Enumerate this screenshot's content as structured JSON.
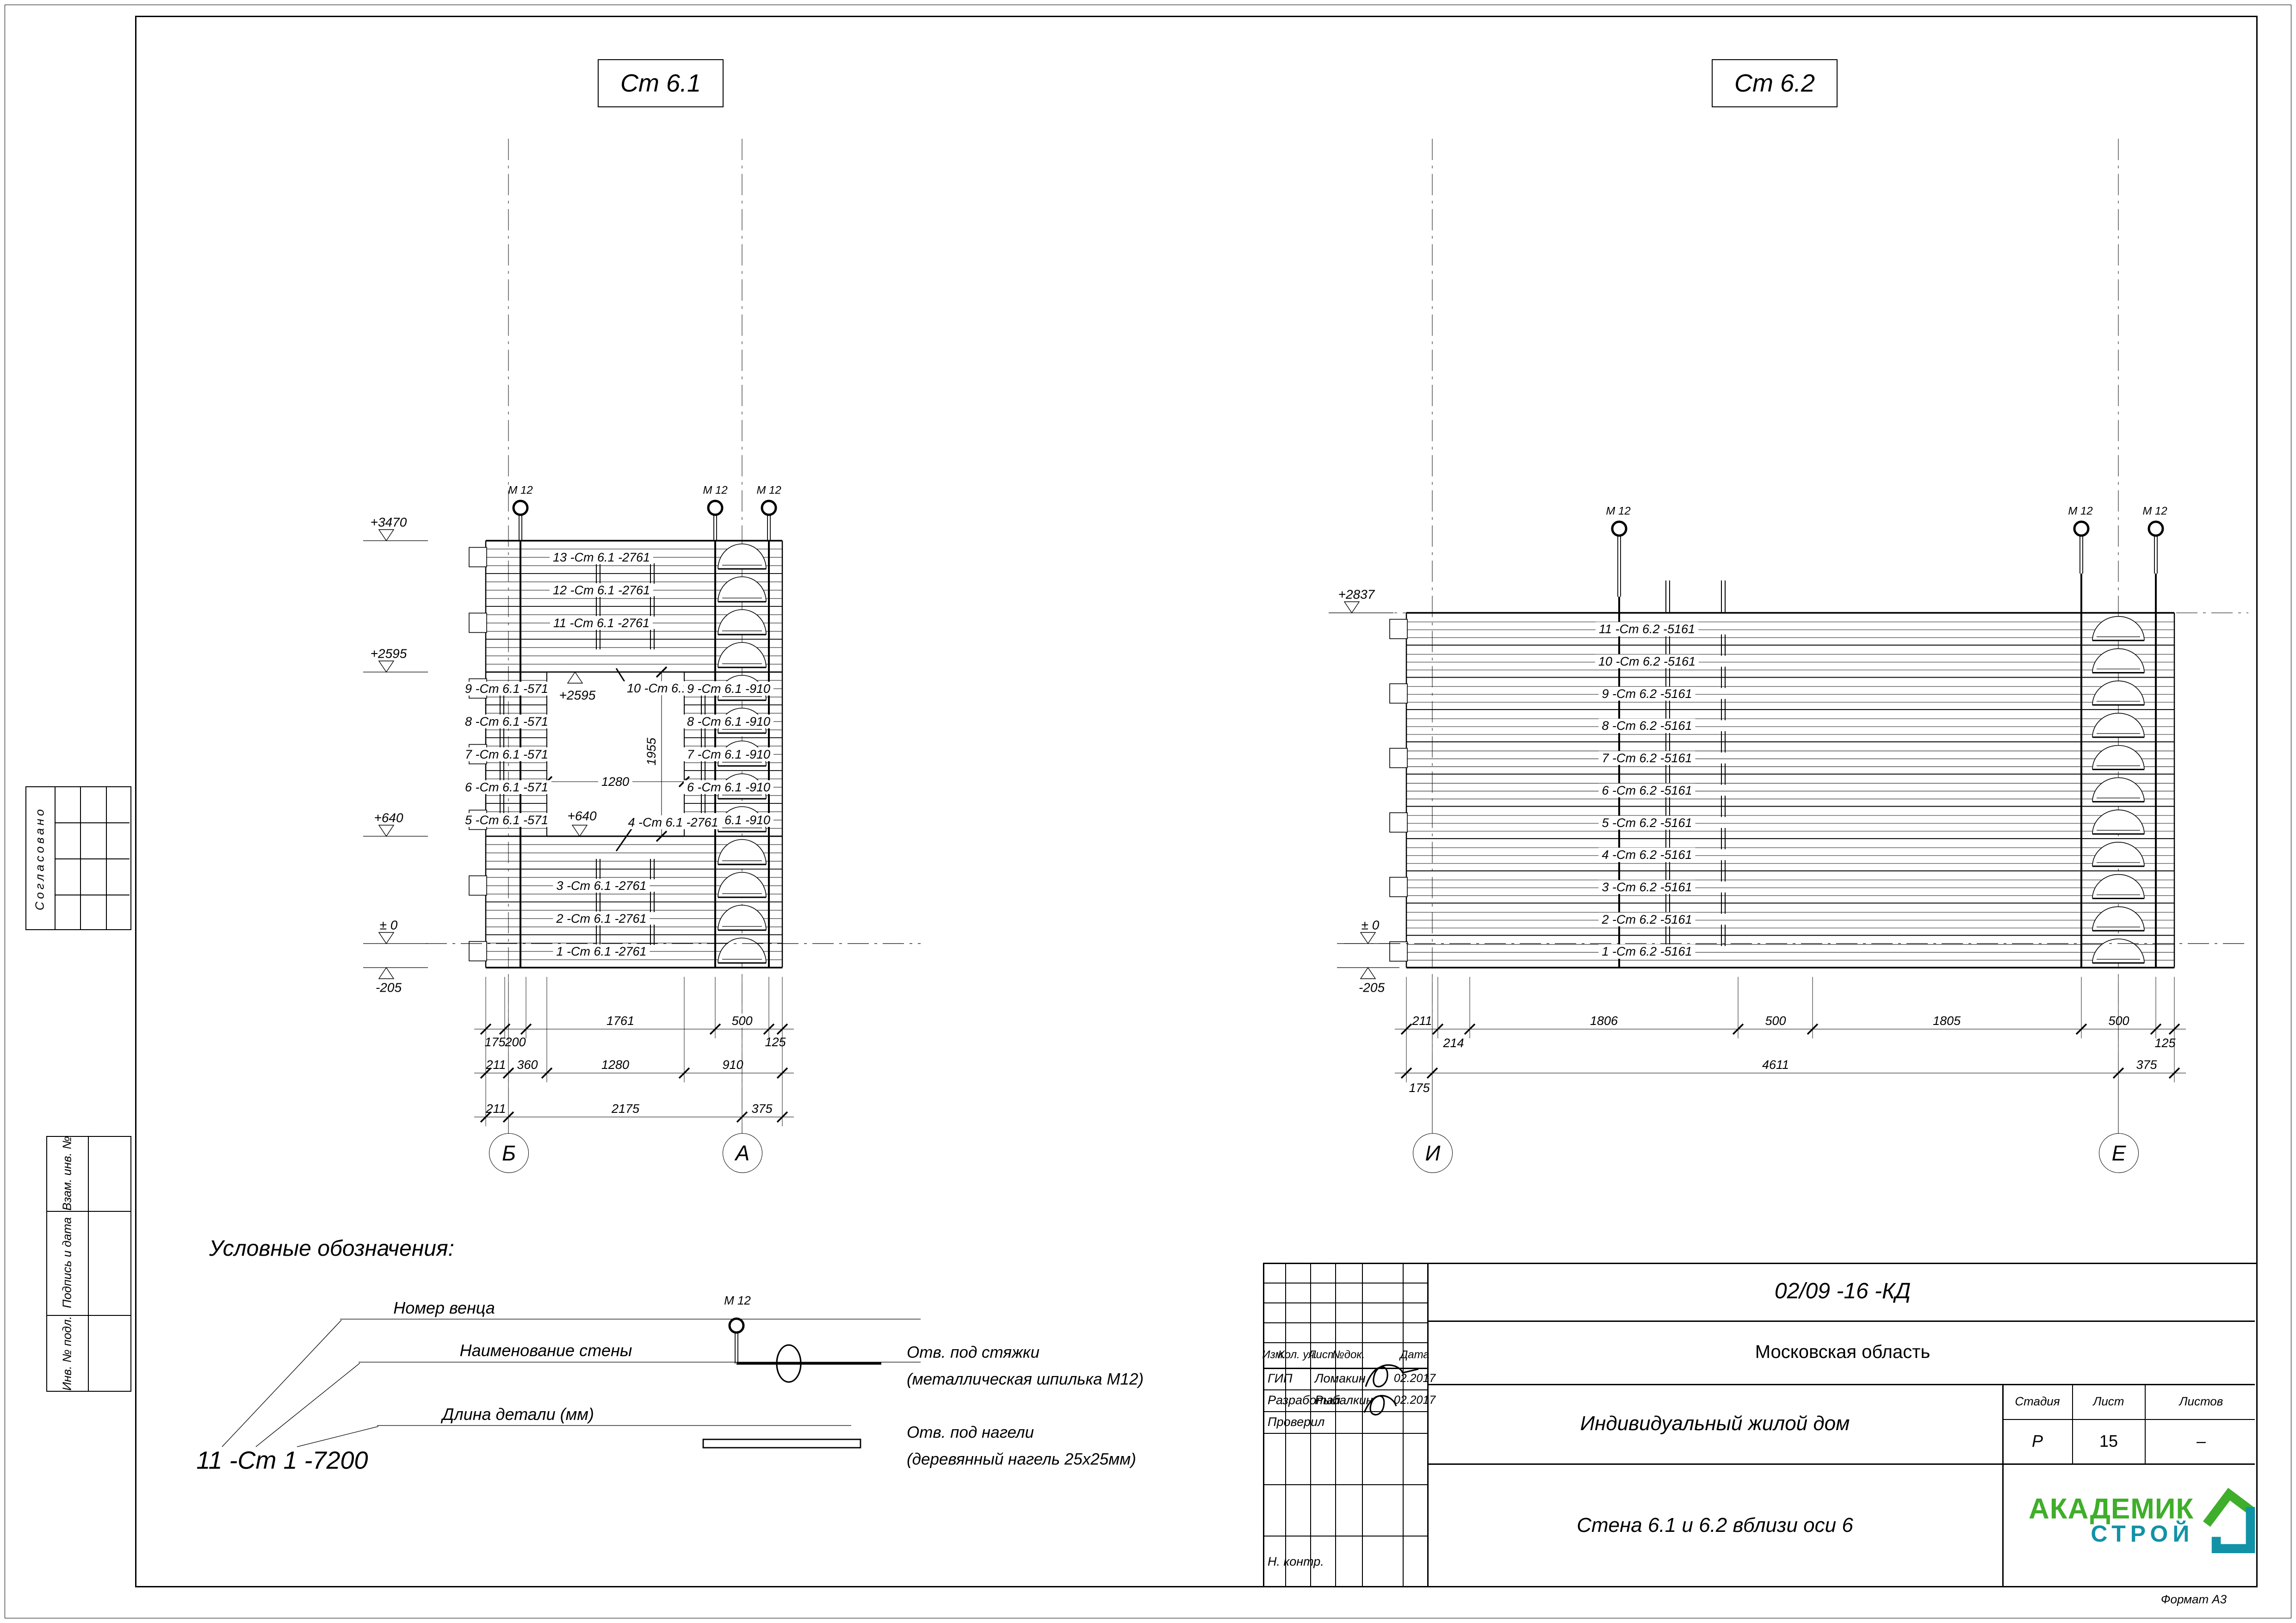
{
  "sheet": {
    "format": "Формат А3",
    "approved": "Согласовано",
    "stamp_side": [
      "Взам. инв. №",
      "Подпись и дата",
      "Инв. № подл."
    ]
  },
  "d1": {
    "title": "Ст 6.1",
    "ties": [
      "М 12",
      "М 12",
      "М 12"
    ],
    "elev": [
      "+3470",
      "+2595",
      "+640",
      "± 0",
      "-205"
    ],
    "elev_open_top": "+2595",
    "elev_open_sill": "+640",
    "courses_top": [
      "13 -Ст 6.1 -2761",
      "12 -Ст 6.1 -2761",
      "11 -Ст 6.1 -2761",
      "10 -Ст 6.1 -2761"
    ],
    "courses_left": [
      "9 -Ст 6.1 -571",
      "8 -Ст 6.1 -571",
      "7 -Ст 6.1 -571",
      "6 -Ст 6.1 -571",
      "5 -Ст 6.1 -571"
    ],
    "courses_right": [
      "9 -Ст 6.1 -910",
      "8 -Ст 6.1 -910",
      "7 -Ст 6.1 -910",
      "6 -Ст 6.1 -910",
      "5 -Ст 6.1 -910"
    ],
    "courses_bottom": [
      "4 -Ст 6.1 -2761",
      "3 -Ст 6.1 -2761",
      "2 -Ст 6.1 -2761",
      "1 -Ст 6.1 -2761"
    ],
    "open_w": "1280",
    "open_h": "1955",
    "dims1": [
      "175",
      "200",
      "1761",
      "500",
      "125"
    ],
    "dims2": [
      "211",
      "360",
      "1280",
      "910"
    ],
    "dims3": [
      "211",
      "2175",
      "375"
    ],
    "axes": [
      "Б",
      "А"
    ]
  },
  "d2": {
    "title": "Ст 6.2",
    "ties": [
      "М 12",
      "М 12",
      "М 12"
    ],
    "elev_top": "+2837",
    "elev_zero": "± 0",
    "elev_bottom": "-205",
    "courses": [
      "11 -Ст 6.2 -5161",
      "10 -Ст 6.2 -5161",
      "9 -Ст 6.2 -5161",
      "8 -Ст 6.2 -5161",
      "7 -Ст 6.2 -5161",
      "6 -Ст 6.2 -5161",
      "5 -Ст 6.2 -5161",
      "4 -Ст 6.2 -5161",
      "3 -Ст 6.2 -5161",
      "2 -Ст 6.2 -5161",
      "1 -Ст 6.2 -5161"
    ],
    "dims1": [
      "211",
      "214",
      "1806",
      "500",
      "1805",
      "500",
      "125"
    ],
    "dims2": [
      "175",
      "4611",
      "375"
    ],
    "axes": [
      "И",
      "Е"
    ]
  },
  "legend": {
    "title": "Условные обозначения:",
    "callout_labels": [
      "Номер венца",
      "Наименование стены",
      "Длина детали (мм)"
    ],
    "example": "11 -Ст 1 -7200",
    "tie_label": "М 12",
    "sym1": [
      "Отв. под стяжки",
      "(металлическая шпилька М12)"
    ],
    "sym2": [
      "Отв. под нагели",
      "(деревянный нагель 25х25мм)"
    ]
  },
  "tb": {
    "doc": "02/09 -16 -КД",
    "region": "Московская область",
    "object": "Индивидуальный жилой дом",
    "sheet_title": "Стена 6.1 и 6.2 вблизи оси 6",
    "cols": [
      "Изм.",
      "Кол. уч.",
      "Лист",
      "№док.",
      "Дата"
    ],
    "rows": [
      {
        "role": "ГИП",
        "name": "Ломакин",
        "date": "02.2017"
      },
      {
        "role": "Разработал",
        "name": "Рыбалкин",
        "date": "02.2017"
      },
      {
        "role": "Проверил",
        "name": "",
        "date": ""
      },
      {
        "role": "Н. контр.",
        "name": "",
        "date": ""
      }
    ],
    "stage_label": "Стадия",
    "stage": "Р",
    "sheet_label": "Лист",
    "sheet_num": "15",
    "sheets_label": "Листов",
    "sheets_num": "–",
    "logo1": "АКАДЕМИК",
    "logo2": "СТРОЙ",
    "logo_green": "#3fae2a",
    "logo_teal": "#1292a6"
  }
}
